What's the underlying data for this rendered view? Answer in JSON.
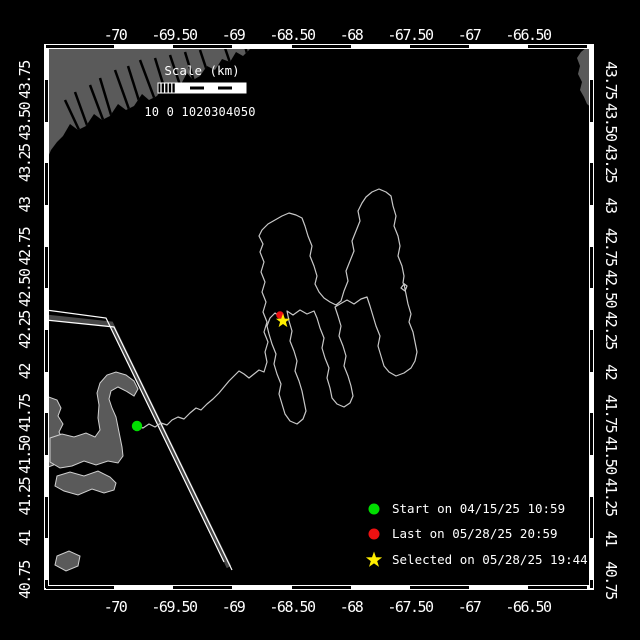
{
  "colors": {
    "background": "#000000",
    "frame": "#ffffff",
    "land": "#5a5a5a",
    "land_outline": "#d0d0d0",
    "track": "#c8c8c8",
    "lane_fill": "#484848",
    "lane_edge": "#ffffff",
    "start_marker": "#00dd00",
    "last_marker": "#ee1111",
    "selected_marker": "#ffee00",
    "text": "#ffffff"
  },
  "geo": {
    "lon_ref": -70,
    "x_ref": 115,
    "px_per_deg_lon": 118,
    "lat_ref": 40.75,
    "y_ref": 580,
    "px_per_deg_lat": 166.67,
    "frame": {
      "x": 46,
      "y": 45,
      "w": 546,
      "h": 544
    }
  },
  "axes": {
    "lon_ticks": [
      {
        "label": "-70",
        "value": -70
      },
      {
        "label": "-69.50",
        "value": -69.5
      },
      {
        "label": "-69",
        "value": -69
      },
      {
        "label": "-68.50",
        "value": -68.5
      },
      {
        "label": "-68",
        "value": -68
      },
      {
        "label": "-67.50",
        "value": -67.5
      },
      {
        "label": "-67",
        "value": -67
      },
      {
        "label": "-66.50",
        "value": -66.5
      }
    ],
    "lat_ticks": [
      {
        "label": "40.75",
        "value": 40.75
      },
      {
        "label": "41",
        "value": 41
      },
      {
        "label": "41.25",
        "value": 41.25
      },
      {
        "label": "41.50",
        "value": 41.5
      },
      {
        "label": "41.75",
        "value": 41.75
      },
      {
        "label": "42",
        "value": 42
      },
      {
        "label": "42.25",
        "value": 42.25
      },
      {
        "label": "42.50",
        "value": 42.5
      },
      {
        "label": "42.75",
        "value": 42.75
      },
      {
        "label": "43",
        "value": 43
      },
      {
        "label": "43.25",
        "value": 43.25
      },
      {
        "label": "43.50",
        "value": 43.5
      },
      {
        "label": "43.75",
        "value": 43.75
      }
    ]
  },
  "scalebar": {
    "title": "Scale (km)",
    "tick_labels": "10 0 1020304050"
  },
  "legend": {
    "items": [
      {
        "marker": "start-dot",
        "color": "#00dd00",
        "label": "Start on 04/15/25 10:59"
      },
      {
        "marker": "last-dot",
        "color": "#ee1111",
        "label": "Last on 05/28/25 20:59"
      },
      {
        "marker": "selected-star",
        "color": "#ffee00",
        "label": "Selected on 05/28/25 19:44"
      }
    ]
  },
  "markers": {
    "start": {
      "x": 137,
      "y": 426
    },
    "last": {
      "x": 280,
      "y": 315
    },
    "selected": {
      "x": 283,
      "y": 321
    }
  },
  "track": {
    "points": [
      [
        137,
        426
      ],
      [
        143,
        428
      ],
      [
        149,
        424
      ],
      [
        155,
        427
      ],
      [
        161,
        423
      ],
      [
        167,
        425
      ],
      [
        172,
        420
      ],
      [
        178,
        417
      ],
      [
        184,
        419
      ],
      [
        190,
        413
      ],
      [
        196,
        408
      ],
      [
        201,
        410
      ],
      [
        207,
        404
      ],
      [
        213,
        399
      ],
      [
        219,
        393
      ],
      [
        224,
        387
      ],
      [
        229,
        381
      ],
      [
        234,
        376
      ],
      [
        239,
        371
      ],
      [
        244,
        374
      ],
      [
        249,
        378
      ],
      [
        254,
        374
      ],
      [
        259,
        370
      ],
      [
        264,
        372
      ],
      [
        267,
        362
      ],
      [
        265,
        352
      ],
      [
        268,
        342
      ],
      [
        264,
        332
      ],
      [
        267,
        322
      ],
      [
        263,
        312
      ],
      [
        266,
        302
      ],
      [
        262,
        292
      ],
      [
        265,
        282
      ],
      [
        261,
        272
      ],
      [
        264,
        262
      ],
      [
        260,
        252
      ],
      [
        263,
        244
      ],
      [
        259,
        236
      ],
      [
        262,
        230
      ],
      [
        268,
        224
      ],
      [
        275,
        220
      ],
      [
        282,
        216
      ],
      [
        289,
        213
      ],
      [
        296,
        215
      ],
      [
        302,
        218
      ],
      [
        305,
        226
      ],
      [
        308,
        236
      ],
      [
        312,
        246
      ],
      [
        310,
        256
      ],
      [
        314,
        266
      ],
      [
        317,
        276
      ],
      [
        315,
        284
      ],
      [
        319,
        292
      ],
      [
        324,
        298
      ],
      [
        330,
        302
      ],
      [
        336,
        305
      ],
      [
        341,
        301
      ],
      [
        344,
        291
      ],
      [
        348,
        281
      ],
      [
        346,
        271
      ],
      [
        350,
        261
      ],
      [
        354,
        251
      ],
      [
        352,
        241
      ],
      [
        356,
        231
      ],
      [
        360,
        221
      ],
      [
        358,
        211
      ],
      [
        362,
        203
      ],
      [
        366,
        197
      ],
      [
        372,
        192
      ],
      [
        379,
        189
      ],
      [
        386,
        192
      ],
      [
        391,
        196
      ],
      [
        393,
        206
      ],
      [
        396,
        216
      ],
      [
        394,
        226
      ],
      [
        398,
        236
      ],
      [
        400,
        246
      ],
      [
        398,
        256
      ],
      [
        402,
        266
      ],
      [
        404,
        276
      ],
      [
        403,
        283
      ],
      [
        407,
        286
      ],
      [
        405,
        291
      ],
      [
        401,
        288
      ],
      [
        404,
        284
      ],
      [
        406,
        294
      ],
      [
        408,
        304
      ],
      [
        411,
        314
      ],
      [
        409,
        322
      ],
      [
        413,
        332
      ],
      [
        415,
        342
      ],
      [
        417,
        352
      ],
      [
        415,
        361
      ],
      [
        411,
        368
      ],
      [
        404,
        373
      ],
      [
        396,
        376
      ],
      [
        389,
        372
      ],
      [
        384,
        366
      ],
      [
        381,
        356
      ],
      [
        378,
        346
      ],
      [
        380,
        336
      ],
      [
        376,
        326
      ],
      [
        373,
        316
      ],
      [
        370,
        306
      ],
      [
        367,
        297
      ],
      [
        361,
        299
      ],
      [
        354,
        304
      ],
      [
        347,
        300
      ],
      [
        340,
        304
      ],
      [
        335,
        307
      ],
      [
        338,
        316
      ],
      [
        341,
        326
      ],
      [
        339,
        336
      ],
      [
        343,
        346
      ],
      [
        346,
        356
      ],
      [
        344,
        366
      ],
      [
        348,
        376
      ],
      [
        351,
        386
      ],
      [
        353,
        396
      ],
      [
        350,
        403
      ],
      [
        344,
        407
      ],
      [
        337,
        404
      ],
      [
        332,
        398
      ],
      [
        330,
        388
      ],
      [
        327,
        378
      ],
      [
        329,
        368
      ],
      [
        325,
        358
      ],
      [
        322,
        348
      ],
      [
        324,
        338
      ],
      [
        320,
        328
      ],
      [
        317,
        318
      ],
      [
        314,
        311
      ],
      [
        307,
        314
      ],
      [
        300,
        310
      ],
      [
        293,
        315
      ],
      [
        287,
        311
      ],
      [
        289,
        321
      ],
      [
        292,
        331
      ],
      [
        290,
        341
      ],
      [
        294,
        351
      ],
      [
        297,
        361
      ],
      [
        295,
        371
      ],
      [
        299,
        381
      ],
      [
        302,
        391
      ],
      [
        304,
        401
      ],
      [
        306,
        411
      ],
      [
        303,
        419
      ],
      [
        297,
        424
      ],
      [
        290,
        421
      ],
      [
        285,
        414
      ],
      [
        282,
        404
      ],
      [
        279,
        394
      ],
      [
        281,
        384
      ],
      [
        277,
        374
      ],
      [
        274,
        364
      ],
      [
        276,
        354
      ],
      [
        272,
        344
      ],
      [
        269,
        334
      ],
      [
        267,
        326
      ],
      [
        270,
        318
      ],
      [
        275,
        313
      ],
      [
        279,
        316
      ],
      [
        280,
        315
      ]
    ]
  },
  "land": {
    "polygons": [
      {
        "name": "maine-coast",
        "outline": false,
        "points": [
          [
            46,
            45
          ],
          [
            250,
            45
          ],
          [
            250,
            49
          ],
          [
            243,
            56
          ],
          [
            236,
            52
          ],
          [
            230,
            62
          ],
          [
            222,
            59
          ],
          [
            215,
            70
          ],
          [
            207,
            66
          ],
          [
            200,
            76
          ],
          [
            193,
            80
          ],
          [
            187,
            73
          ],
          [
            180,
            86
          ],
          [
            172,
            90
          ],
          [
            165,
            84
          ],
          [
            157,
            96
          ],
          [
            149,
            100
          ],
          [
            142,
            94
          ],
          [
            134,
            106
          ],
          [
            126,
            110
          ],
          [
            118,
            104
          ],
          [
            110,
            116
          ],
          [
            102,
            120
          ],
          [
            94,
            114
          ],
          [
            86,
            126
          ],
          [
            78,
            130
          ],
          [
            70,
            124
          ],
          [
            63,
            136
          ],
          [
            57,
            142
          ],
          [
            51,
            150
          ],
          [
            48,
            157
          ],
          [
            46,
            162
          ]
        ]
      },
      {
        "name": "nova-scotia",
        "outline": false,
        "points": [
          [
            592,
            48
          ],
          [
            592,
            108
          ],
          [
            587,
            104
          ],
          [
            584,
            97
          ],
          [
            580,
            90
          ],
          [
            582,
            82
          ],
          [
            578,
            74
          ],
          [
            580,
            66
          ],
          [
            577,
            58
          ],
          [
            581,
            52
          ],
          [
            586,
            48
          ]
        ]
      },
      {
        "name": "plymouth-shore",
        "outline": true,
        "points": [
          [
            46,
            396
          ],
          [
            57,
            400
          ],
          [
            61,
            408
          ],
          [
            58,
            416
          ],
          [
            63,
            424
          ],
          [
            59,
            432
          ],
          [
            63,
            440
          ],
          [
            58,
            448
          ],
          [
            62,
            456
          ],
          [
            56,
            464
          ],
          [
            46,
            468
          ]
        ]
      },
      {
        "name": "cape-cod-hook",
        "outline": true,
        "points": [
          [
            50,
            438
          ],
          [
            62,
            434
          ],
          [
            74,
            437
          ],
          [
            86,
            433
          ],
          [
            95,
            437
          ],
          [
            100,
            430
          ],
          [
            98,
            418
          ],
          [
            99,
            405
          ],
          [
            97,
            393
          ],
          [
            100,
            383
          ],
          [
            107,
            375
          ],
          [
            116,
            372
          ],
          [
            126,
            375
          ],
          [
            134,
            381
          ],
          [
            138,
            389
          ],
          [
            134,
            396
          ],
          [
            126,
            391
          ],
          [
            118,
            387
          ],
          [
            111,
            391
          ],
          [
            109,
            399
          ],
          [
            112,
            408
          ],
          [
            116,
            417
          ],
          [
            118,
            427
          ],
          [
            120,
            437
          ],
          [
            122,
            447
          ],
          [
            123,
            456
          ],
          [
            118,
            463
          ],
          [
            108,
            461
          ],
          [
            96,
            465
          ],
          [
            84,
            461
          ],
          [
            72,
            466
          ],
          [
            60,
            468
          ],
          [
            50,
            462
          ]
        ]
      },
      {
        "name": "lower-cape",
        "outline": true,
        "points": [
          [
            57,
            476
          ],
          [
            70,
            472
          ],
          [
            84,
            476
          ],
          [
            98,
            471
          ],
          [
            110,
            477
          ],
          [
            116,
            483
          ],
          [
            114,
            490
          ],
          [
            104,
            493
          ],
          [
            92,
            489
          ],
          [
            78,
            495
          ],
          [
            64,
            491
          ],
          [
            55,
            486
          ]
        ]
      },
      {
        "name": "nantucket-island",
        "outline": true,
        "points": [
          [
            57,
            556
          ],
          [
            69,
            551
          ],
          [
            80,
            556
          ],
          [
            78,
            566
          ],
          [
            66,
            571
          ],
          [
            55,
            565
          ]
        ]
      }
    ],
    "streaks": [
      [
        245,
        46,
        252,
        72
      ],
      [
        225,
        48,
        238,
        86
      ],
      [
        200,
        50,
        215,
        95
      ],
      [
        185,
        52,
        196,
        88
      ],
      [
        170,
        55,
        185,
        100
      ],
      [
        155,
        58,
        168,
        100
      ],
      [
        140,
        60,
        158,
        108
      ],
      [
        128,
        66,
        140,
        104
      ],
      [
        115,
        70,
        130,
        112
      ],
      [
        100,
        78,
        112,
        118
      ],
      [
        90,
        85,
        105,
        125
      ],
      [
        75,
        92,
        88,
        128
      ],
      [
        65,
        100,
        80,
        132
      ]
    ]
  },
  "shipping_lane": {
    "line_a": [
      [
        46,
        310
      ],
      [
        106,
        318
      ],
      [
        224,
        562
      ]
    ],
    "band": [
      [
        46,
        317
      ],
      [
        111,
        324
      ],
      [
        229,
        567
      ]
    ],
    "line_b": [
      [
        46,
        320
      ],
      [
        114,
        327
      ],
      [
        232,
        570
      ]
    ]
  }
}
